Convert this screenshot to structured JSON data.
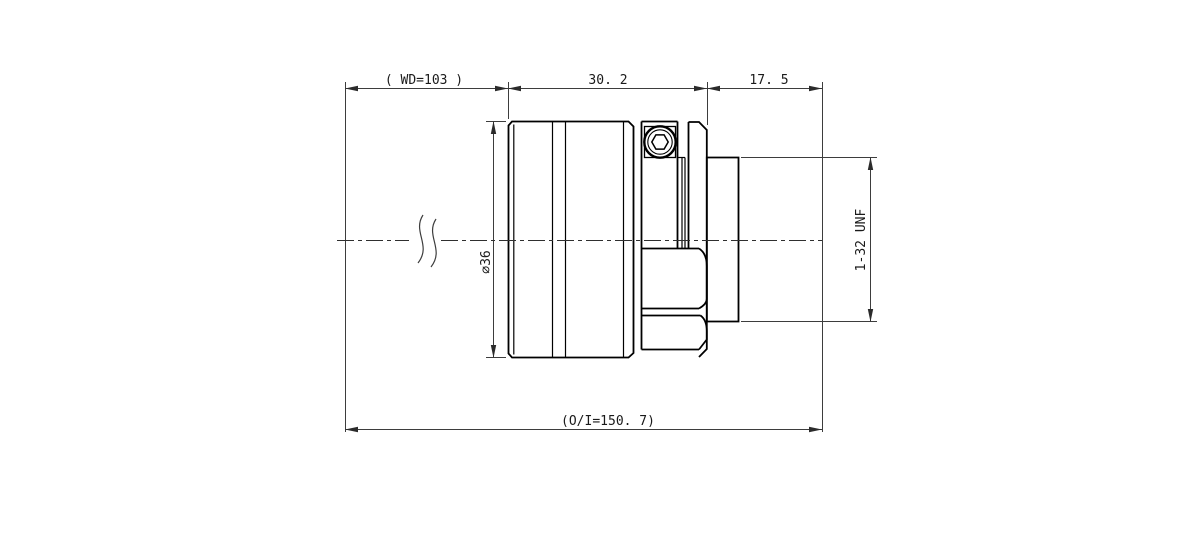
{
  "drawing": {
    "type": "mechanical-lens-drawing",
    "background_color": "#ffffff",
    "outline_color": "#000000",
    "dimension_color": "#3d3d3d",
    "dimensions": {
      "working_distance": "( WD=103 )",
      "body_length": "30. 2",
      "mount_length": "17. 5",
      "barrel_diameter": "∅36",
      "thread_spec": "1-32 UNF",
      "overall_length": "(O/I=150. 7)"
    }
  }
}
